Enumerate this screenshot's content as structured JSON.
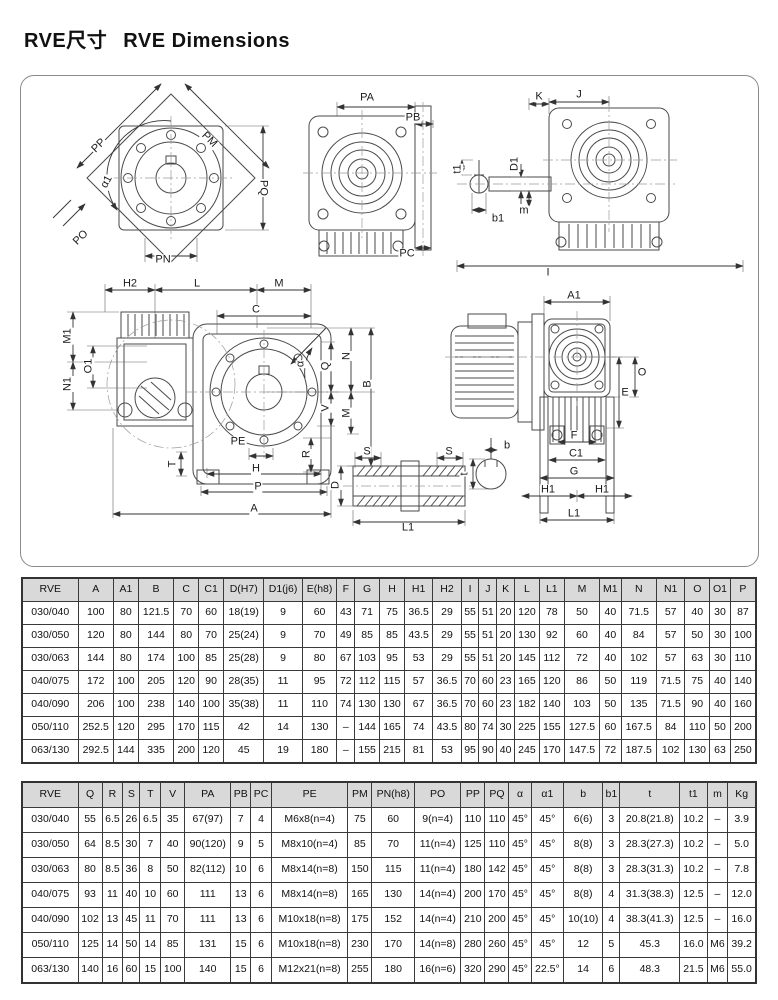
{
  "header": {
    "title_cn": "RVE尺寸",
    "title_en": "RVE Dimensions"
  },
  "drawing": {
    "labels": [
      {
        "t": "PP",
        "x": 78,
        "y": 70,
        "r": -45
      },
      {
        "t": "PM",
        "x": 188,
        "y": 64,
        "r": 45
      },
      {
        "t": "α1",
        "x": 86,
        "y": 106,
        "r": -62
      },
      {
        "t": "PQ",
        "x": 242,
        "y": 112,
        "r": 90
      },
      {
        "t": "PO",
        "x": 60,
        "y": 162,
        "r": -45
      },
      {
        "t": "PN",
        "x": 142,
        "y": 184,
        "r": 0
      },
      {
        "t": "PA",
        "x": 346,
        "y": 22,
        "r": 0
      },
      {
        "t": "PB",
        "x": 392,
        "y": 42,
        "r": 0
      },
      {
        "t": "PC",
        "x": 386,
        "y": 178,
        "r": 0
      },
      {
        "t": "K",
        "x": 518,
        "y": 21,
        "r": 0
      },
      {
        "t": "J",
        "x": 558,
        "y": 19,
        "r": 0
      },
      {
        "t": "t1",
        "x": 437,
        "y": 93,
        "r": -90
      },
      {
        "t": "D1",
        "x": 494,
        "y": 88,
        "r": -90
      },
      {
        "t": "m",
        "x": 503,
        "y": 135,
        "r": 0
      },
      {
        "t": "b1",
        "x": 477,
        "y": 143,
        "r": 0
      },
      {
        "t": "I",
        "x": 527,
        "y": 197,
        "r": 0
      },
      {
        "t": "H2",
        "x": 109,
        "y": 208,
        "r": 0
      },
      {
        "t": "L",
        "x": 176,
        "y": 208,
        "r": 0
      },
      {
        "t": "M",
        "x": 258,
        "y": 208,
        "r": 0
      },
      {
        "t": "C",
        "x": 235,
        "y": 234,
        "r": 0
      },
      {
        "t": "M1",
        "x": 47,
        "y": 260,
        "r": -90
      },
      {
        "t": "O1",
        "x": 68,
        "y": 290,
        "r": -90
      },
      {
        "t": "N1",
        "x": 47,
        "y": 308,
        "r": -90
      },
      {
        "t": "Q",
        "x": 305,
        "y": 290,
        "r": -90
      },
      {
        "t": "N",
        "x": 326,
        "y": 280,
        "r": -90
      },
      {
        "t": "B",
        "x": 347,
        "y": 308,
        "r": -90
      },
      {
        "t": "V",
        "x": 305,
        "y": 332,
        "r": -90
      },
      {
        "t": "M",
        "x": 326,
        "y": 337,
        "r": -90
      },
      {
        "t": "α",
        "x": 280,
        "y": 288,
        "r": -90
      },
      {
        "t": "R",
        "x": 286,
        "y": 378,
        "r": -90
      },
      {
        "t": "PE",
        "x": 217,
        "y": 366,
        "r": 0
      },
      {
        "t": "T",
        "x": 152,
        "y": 388,
        "r": -90
      },
      {
        "t": "H",
        "x": 235,
        "y": 393,
        "r": 0
      },
      {
        "t": "P",
        "x": 237,
        "y": 411,
        "r": 0
      },
      {
        "t": "A",
        "x": 233,
        "y": 433,
        "r": 0
      },
      {
        "t": "S",
        "x": 346,
        "y": 376,
        "r": 0
      },
      {
        "t": "S",
        "x": 428,
        "y": 376,
        "r": 0
      },
      {
        "t": "D",
        "x": 315,
        "y": 409,
        "r": -90
      },
      {
        "t": "L1",
        "x": 387,
        "y": 452,
        "r": 0
      },
      {
        "t": "A1",
        "x": 553,
        "y": 220,
        "r": 0
      },
      {
        "t": "O",
        "x": 621,
        "y": 297,
        "r": 0
      },
      {
        "t": "E",
        "x": 604,
        "y": 317,
        "r": 0
      },
      {
        "t": "b",
        "x": 486,
        "y": 370,
        "r": 0
      },
      {
        "t": "t",
        "x": 444,
        "y": 398,
        "r": -90
      },
      {
        "t": "F",
        "x": 553,
        "y": 360,
        "r": 0
      },
      {
        "t": "C1",
        "x": 555,
        "y": 378,
        "r": 0
      },
      {
        "t": "G",
        "x": 553,
        "y": 396,
        "r": 0
      },
      {
        "t": "H1",
        "x": 527,
        "y": 414,
        "r": 0
      },
      {
        "t": "H1",
        "x": 581,
        "y": 414,
        "r": 0
      },
      {
        "t": "L1",
        "x": 553,
        "y": 438,
        "r": 0
      }
    ]
  },
  "table1": {
    "headers": [
      "RVE",
      "A",
      "A1",
      "B",
      "C",
      "C1",
      "D(H7)",
      "D1(j6)",
      "E(h8)",
      "F",
      "G",
      "H",
      "H1",
      "H2",
      "I",
      "J",
      "K",
      "L",
      "L1",
      "M",
      "M1",
      "N",
      "N1",
      "O",
      "O1",
      "P"
    ],
    "rows": [
      [
        "030/040",
        "100",
        "80",
        "121.5",
        "70",
        "60",
        "18(19)",
        "9",
        "60",
        "43",
        "71",
        "75",
        "36.5",
        "29",
        "55",
        "51",
        "20",
        "120",
        "78",
        "50",
        "40",
        "71.5",
        "57",
        "40",
        "30",
        "87"
      ],
      [
        "030/050",
        "120",
        "80",
        "144",
        "80",
        "70",
        "25(24)",
        "9",
        "70",
        "49",
        "85",
        "85",
        "43.5",
        "29",
        "55",
        "51",
        "20",
        "130",
        "92",
        "60",
        "40",
        "84",
        "57",
        "50",
        "30",
        "100"
      ],
      [
        "030/063",
        "144",
        "80",
        "174",
        "100",
        "85",
        "25(28)",
        "9",
        "80",
        "67",
        "103",
        "95",
        "53",
        "29",
        "55",
        "51",
        "20",
        "145",
        "112",
        "72",
        "40",
        "102",
        "57",
        "63",
        "30",
        "110"
      ],
      [
        "040/075",
        "172",
        "100",
        "205",
        "120",
        "90",
        "28(35)",
        "11",
        "95",
        "72",
        "112",
        "115",
        "57",
        "36.5",
        "70",
        "60",
        "23",
        "165",
        "120",
        "86",
        "50",
        "119",
        "71.5",
        "75",
        "40",
        "140"
      ],
      [
        "040/090",
        "206",
        "100",
        "238",
        "140",
        "100",
        "35(38)",
        "11",
        "110",
        "74",
        "130",
        "130",
        "67",
        "36.5",
        "70",
        "60",
        "23",
        "182",
        "140",
        "103",
        "50",
        "135",
        "71.5",
        "90",
        "40",
        "160"
      ],
      [
        "050/110",
        "252.5",
        "120",
        "295",
        "170",
        "115",
        "42",
        "14",
        "130",
        "–",
        "144",
        "165",
        "74",
        "43.5",
        "80",
        "74",
        "30",
        "225",
        "155",
        "127.5",
        "60",
        "167.5",
        "84",
        "110",
        "50",
        "200"
      ],
      [
        "063/130",
        "292.5",
        "144",
        "335",
        "200",
        "120",
        "45",
        "19",
        "180",
        "–",
        "155",
        "215",
        "81",
        "53",
        "95",
        "90",
        "40",
        "245",
        "170",
        "147.5",
        "72",
        "187.5",
        "102",
        "130",
        "63",
        "250"
      ]
    ]
  },
  "table2": {
    "headers": [
      "RVE",
      "Q",
      "R",
      "S",
      "T",
      "V",
      "PA",
      "PB",
      "PC",
      "PE",
      "PM",
      "PN(h8)",
      "PO",
      "PP",
      "PQ",
      "α",
      "α1",
      "b",
      "b1",
      "t",
      "t1",
      "m",
      "Kg"
    ],
    "rows": [
      [
        "030/040",
        "55",
        "6.5",
        "26",
        "6.5",
        "35",
        "67(97)",
        "7",
        "4",
        "M6x8(n=4)",
        "75",
        "60",
        "9(n=4)",
        "110",
        "110",
        "45°",
        "45°",
        "6(6)",
        "3",
        "20.8(21.8)",
        "10.2",
        "–",
        "3.9"
      ],
      [
        "030/050",
        "64",
        "8.5",
        "30",
        "7",
        "40",
        "90(120)",
        "9",
        "5",
        "M8x10(n=4)",
        "85",
        "70",
        "11(n=4)",
        "125",
        "110",
        "45°",
        "45°",
        "8(8)",
        "3",
        "28.3(27.3)",
        "10.2",
        "–",
        "5.0"
      ],
      [
        "030/063",
        "80",
        "8.5",
        "36",
        "8",
        "50",
        "82(112)",
        "10",
        "6",
        "M8x14(n=8)",
        "150",
        "115",
        "11(n=4)",
        "180",
        "142",
        "45°",
        "45°",
        "8(8)",
        "3",
        "28.3(31.3)",
        "10.2",
        "–",
        "7.8"
      ],
      [
        "040/075",
        "93",
        "11",
        "40",
        "10",
        "60",
        "111",
        "13",
        "6",
        "M8x14(n=8)",
        "165",
        "130",
        "14(n=4)",
        "200",
        "170",
        "45°",
        "45°",
        "8(8)",
        "4",
        "31.3(38.3)",
        "12.5",
        "–",
        "12.0"
      ],
      [
        "040/090",
        "102",
        "13",
        "45",
        "11",
        "70",
        "111",
        "13",
        "6",
        "M10x18(n=8)",
        "175",
        "152",
        "14(n=4)",
        "210",
        "200",
        "45°",
        "45°",
        "10(10)",
        "4",
        "38.3(41.3)",
        "12.5",
        "–",
        "16.0"
      ],
      [
        "050/110",
        "125",
        "14",
        "50",
        "14",
        "85",
        "131",
        "15",
        "6",
        "M10x18(n=8)",
        "230",
        "170",
        "14(n=8)",
        "280",
        "260",
        "45°",
        "45°",
        "12",
        "5",
        "45.3",
        "16.0",
        "M6",
        "39.2"
      ],
      [
        "063/130",
        "140",
        "16",
        "60",
        "15",
        "100",
        "140",
        "15",
        "6",
        "M12x21(n=8)",
        "255",
        "180",
        "16(n=6)",
        "320",
        "290",
        "45°",
        "22.5°",
        "14",
        "6",
        "48.3",
        "21.5",
        "M6",
        "55.0"
      ]
    ]
  }
}
